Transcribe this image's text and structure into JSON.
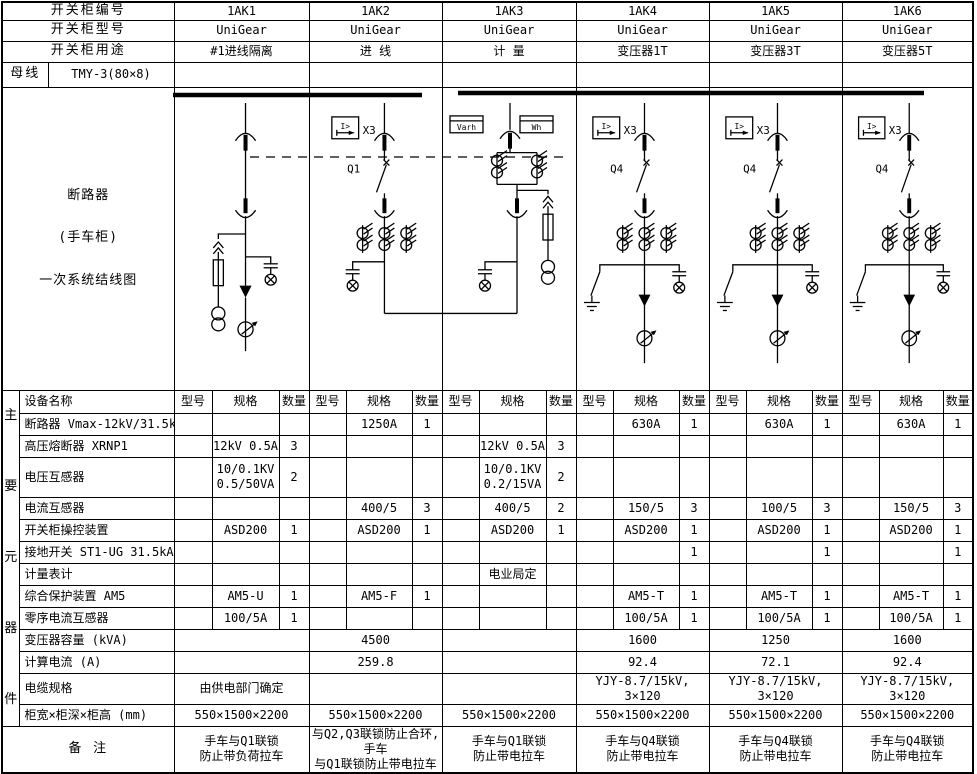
{
  "header": {
    "rows": [
      {
        "label": "开关柜编号",
        "values": [
          "1AK1",
          "1AK2",
          "1AK3",
          "1AK4",
          "1AK5",
          "1AK6"
        ]
      },
      {
        "label": "开关柜型号",
        "values": [
          "UniGear",
          "UniGear",
          "UniGear",
          "UniGear",
          "UniGear",
          "UniGear"
        ]
      },
      {
        "label": "开关柜用途",
        "values": [
          "#1进线隔离",
          "进 线",
          "计 量",
          "变压器1T",
          "变压器3T",
          "变压器5T"
        ]
      }
    ],
    "busbar": {
      "label": "母线",
      "spec": "TMY-3(80×8)"
    }
  },
  "diagram": {
    "title_lines": [
      "断路器",
      "(手车柜)",
      "一次系统结线图"
    ],
    "labels": {
      "relay": "X3",
      "relay_symbol": "I>",
      "q1": "Q1",
      "q4": "Q4",
      "varh": "Varh",
      "wh": "Wh"
    }
  },
  "table": {
    "side_chars": [
      "主",
      "要",
      "元",
      "器",
      "件"
    ],
    "col_headers": {
      "name": "设备名称",
      "model": "型号",
      "spec": "规格",
      "qty": "数量"
    },
    "rows": [
      {
        "name": "断路器 Vmax-12kV/31.5kA",
        "merged": false,
        "cells": [
          [
            "",
            "",
            ""
          ],
          [
            "",
            "1250A",
            "1"
          ],
          [
            "",
            "",
            ""
          ],
          [
            "",
            "630A",
            "1"
          ],
          [
            "",
            "630A",
            "1"
          ],
          [
            "",
            "630A",
            "1"
          ]
        ]
      },
      {
        "name": "高压熔断器 XRNP1",
        "merged": false,
        "cells": [
          [
            "",
            "12kV 0.5A",
            "3"
          ],
          [
            "",
            "",
            ""
          ],
          [
            "",
            "12kV 0.5A",
            "3"
          ],
          [
            "",
            "",
            ""
          ],
          [
            "",
            "",
            ""
          ],
          [
            "",
            "",
            ""
          ]
        ]
      },
      {
        "name": "电压互感器",
        "merged": false,
        "h": 40,
        "cells": [
          [
            "",
            "10/0.1KV\n0.5/50VA",
            "2"
          ],
          [
            "",
            "",
            ""
          ],
          [
            "",
            "10/0.1KV\n0.2/15VA",
            "2"
          ],
          [
            "",
            "",
            ""
          ],
          [
            "",
            "",
            ""
          ],
          [
            "",
            "",
            ""
          ]
        ]
      },
      {
        "name": "电流互感器",
        "merged": false,
        "cells": [
          [
            "",
            "",
            ""
          ],
          [
            "",
            "400/5",
            "3"
          ],
          [
            "",
            "400/5",
            "2"
          ],
          [
            "",
            "150/5",
            "3"
          ],
          [
            "",
            "100/5",
            "3"
          ],
          [
            "",
            "150/5",
            "3"
          ]
        ]
      },
      {
        "name": "开关柜操控装置",
        "merged": false,
        "cells": [
          [
            "",
            "ASD200",
            "1"
          ],
          [
            "",
            "ASD200",
            "1"
          ],
          [
            "",
            "ASD200",
            "1"
          ],
          [
            "",
            "ASD200",
            "1"
          ],
          [
            "",
            "ASD200",
            "1"
          ],
          [
            "",
            "ASD200",
            "1"
          ]
        ]
      },
      {
        "name": "接地开关  ST1-UG 31.5kA",
        "merged": false,
        "cells": [
          [
            "",
            "",
            ""
          ],
          [
            "",
            "",
            ""
          ],
          [
            "",
            "",
            ""
          ],
          [
            "",
            "",
            "1"
          ],
          [
            "",
            "",
            "1"
          ],
          [
            "",
            "",
            "1"
          ]
        ]
      },
      {
        "name": "计量表计",
        "merged": false,
        "cells": [
          [
            "",
            "",
            ""
          ],
          [
            "",
            "",
            ""
          ],
          [
            "",
            "电业局定",
            ""
          ],
          [
            "",
            "",
            ""
          ],
          [
            "",
            "",
            ""
          ],
          [
            "",
            "",
            ""
          ]
        ]
      },
      {
        "name": "综合保护装置  AM5",
        "merged": false,
        "cells": [
          [
            "",
            "AM5-U",
            "1"
          ],
          [
            "",
            "AM5-F",
            "1"
          ],
          [
            "",
            "",
            ""
          ],
          [
            "",
            "AM5-T",
            "1"
          ],
          [
            "",
            "AM5-T",
            "1"
          ],
          [
            "",
            "AM5-T",
            "1"
          ]
        ]
      },
      {
        "name": "零序电流互感器",
        "merged": false,
        "cells": [
          [
            "",
            "100/5A",
            "1"
          ],
          [
            "",
            "",
            ""
          ],
          [
            "",
            "",
            ""
          ],
          [
            "",
            "100/5A",
            "1"
          ],
          [
            "",
            "100/5A",
            "1"
          ],
          [
            "",
            "100/5A",
            "1"
          ]
        ]
      },
      {
        "name": "变压器容量 (kVA)",
        "merged": true,
        "cells": [
          "",
          "4500",
          "",
          "1600",
          "1250",
          "1600"
        ]
      },
      {
        "name": "计算电流 (A)",
        "merged": true,
        "cells": [
          "",
          "259.8",
          "",
          "92.4",
          "72.1",
          "92.4"
        ]
      },
      {
        "name": "电缆规格",
        "merged": true,
        "cells": [
          "由供电部门确定",
          "",
          "",
          "YJY-8.7/15kV, 3×120",
          "YJY-8.7/15kV, 3×120",
          "YJY-8.7/15kV, 3×120"
        ]
      },
      {
        "name": "柜宽×柜深×柜高 (mm)",
        "merged": true,
        "cells": [
          "550×1500×2200",
          "550×1500×2200",
          "550×1500×2200",
          "550×1500×2200",
          "550×1500×2200",
          "550×1500×2200"
        ]
      }
    ],
    "remark_label": "备 注",
    "remarks": [
      "手车与Q1联锁\n防止带负荷拉车",
      "与Q2,Q3联锁防止合环,手车\n与Q1联锁防止带电拉车",
      "手车与Q1联锁\n防止带电拉车",
      "手车与Q4联锁\n防止带电拉车",
      "手车与Q4联锁\n防止带电拉车",
      "手车与Q4联锁\n防止带电拉车"
    ]
  }
}
